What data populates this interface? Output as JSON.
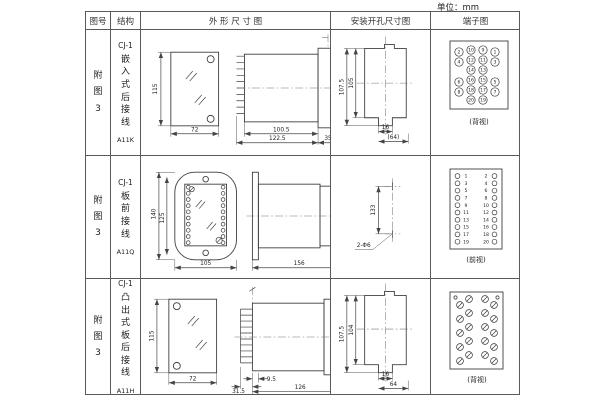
{
  "unit_label": "单位：mm",
  "headers": {
    "fig_no": "图号",
    "structure": "结构",
    "outline": "外 形 尺 寸 图",
    "install": "安装开孔尺寸图",
    "terminal": "端子图"
  },
  "rows": [
    {
      "fig_no": "附图3",
      "structure": {
        "code": "CJ-1",
        "name": "嵌入式后接线",
        "model": "A11K"
      },
      "outline": {
        "front_height": "115",
        "front_width": "72",
        "side_body": "100.5",
        "side_total": "122.5",
        "side_flange": "35"
      },
      "install": {
        "v_outer": "107.5",
        "v_inner": "105",
        "h_tab": "16",
        "h_overall": "(64)"
      },
      "terminal": {
        "view": "(背视)",
        "points": [
          {
            "n": "2",
            "x": 28,
            "y": 22,
            "r": 4.2
          },
          {
            "n": "4",
            "x": 28,
            "y": 32,
            "r": 4.2
          },
          {
            "n": "6",
            "x": 28,
            "y": 52,
            "r": 4.2
          },
          {
            "n": "8",
            "x": 28,
            "y": 62,
            "r": 4.2
          },
          {
            "n": "10",
            "x": 40,
            "y": 20,
            "r": 4.2
          },
          {
            "n": "12",
            "x": 40,
            "y": 30,
            "r": 4.2
          },
          {
            "n": "14",
            "x": 40,
            "y": 40,
            "r": 4.2
          },
          {
            "n": "16",
            "x": 40,
            "y": 50,
            "r": 4.2
          },
          {
            "n": "18",
            "x": 40,
            "y": 60,
            "r": 4.2
          },
          {
            "n": "20",
            "x": 40,
            "y": 70,
            "r": 4.2
          },
          {
            "n": "9",
            "x": 52,
            "y": 20,
            "r": 4.2
          },
          {
            "n": "11",
            "x": 52,
            "y": 30,
            "r": 4.2
          },
          {
            "n": "13",
            "x": 52,
            "y": 40,
            "r": 4.2
          },
          {
            "n": "15",
            "x": 52,
            "y": 50,
            "r": 4.2
          },
          {
            "n": "17",
            "x": 52,
            "y": 60,
            "r": 4.2
          },
          {
            "n": "19",
            "x": 52,
            "y": 70,
            "r": 4.2
          },
          {
            "n": "1",
            "x": 64,
            "y": 22,
            "r": 4.2
          },
          {
            "n": "3",
            "x": 64,
            "y": 32,
            "r": 4.2
          },
          {
            "n": "5",
            "x": 64,
            "y": 52,
            "r": 4.2
          },
          {
            "n": "7",
            "x": 64,
            "y": 62,
            "r": 4.2
          }
        ]
      }
    },
    {
      "fig_no": "附图3",
      "structure": {
        "code": "CJ-1",
        "name": "板前接线",
        "model": "A11Q"
      },
      "outline": {
        "front_outer": "140",
        "front_inner": "125",
        "front_width": "105",
        "side_length": "156",
        "side_height": "115",
        "plate_points": [
          {
            "x": 47.5,
            "y": 31,
            "r": 1.9
          },
          {
            "x": 47.5,
            "y": 37.2,
            "r": 1.9
          },
          {
            "x": 47.5,
            "y": 43.4,
            "r": 1.9
          },
          {
            "x": 47.5,
            "y": 49.6,
            "r": 1.9
          },
          {
            "x": 47.5,
            "y": 55.8,
            "r": 1.9
          },
          {
            "x": 47.5,
            "y": 62,
            "r": 1.9
          },
          {
            "x": 47.5,
            "y": 68.2,
            "r": 1.9
          },
          {
            "x": 47.5,
            "y": 74.4,
            "r": 1.9
          },
          {
            "x": 47.5,
            "y": 80.6,
            "r": 1.9
          },
          {
            "x": 47.5,
            "y": 86.8,
            "r": 1.9
          },
          {
            "x": 82.5,
            "y": 31,
            "r": 1.9
          },
          {
            "x": 82.5,
            "y": 37.2,
            "r": 1.9
          },
          {
            "x": 82.5,
            "y": 43.4,
            "r": 1.9
          },
          {
            "x": 82.5,
            "y": 49.6,
            "r": 1.9
          },
          {
            "x": 82.5,
            "y": 55.8,
            "r": 1.9
          },
          {
            "x": 82.5,
            "y": 62,
            "r": 1.9
          },
          {
            "x": 82.5,
            "y": 68.2,
            "r": 1.9
          },
          {
            "x": 82.5,
            "y": 74.4,
            "r": 1.9
          },
          {
            "x": 82.5,
            "y": 80.6,
            "r": 1.9
          },
          {
            "x": 82.5,
            "y": 86.8,
            "r": 1.9
          },
          {
            "x": 78.5,
            "y": 84.5,
            "r": 3.1,
            "slot": true
          },
          {
            "x": 51,
            "y": 33,
            "r": 2.6,
            "slot": true
          }
        ]
      },
      "install": {
        "span": "133",
        "holes": "2-Φ6"
      },
      "terminal": {
        "view": "(前视)",
        "points": [
          {
            "n": "1",
            "x": 26.5,
            "y": 20,
            "r": 2.4,
            "lx": 35,
            "ly": 20
          },
          {
            "n": "3",
            "x": 26.5,
            "y": 27.3,
            "r": 2.4,
            "lx": 35,
            "ly": 27.3
          },
          {
            "n": "5",
            "x": 26.5,
            "y": 34.6,
            "r": 2.4,
            "lx": 35,
            "ly": 34.6
          },
          {
            "n": "7",
            "x": 26.5,
            "y": 41.9,
            "r": 2.4,
            "lx": 35,
            "ly": 41.9
          },
          {
            "n": "9",
            "x": 26.5,
            "y": 49.2,
            "r": 2.4,
            "lx": 35,
            "ly": 49.2
          },
          {
            "n": "11",
            "x": 26.5,
            "y": 56.5,
            "r": 2.4,
            "lx": 35,
            "ly": 56.5
          },
          {
            "n": "13",
            "x": 26.5,
            "y": 63.8,
            "r": 2.4,
            "lx": 35,
            "ly": 63.8
          },
          {
            "n": "15",
            "x": 26.5,
            "y": 71.1,
            "r": 2.4,
            "lx": 35,
            "ly": 71.1
          },
          {
            "n": "17",
            "x": 26.5,
            "y": 78.4,
            "r": 2.4,
            "lx": 35,
            "ly": 78.4
          },
          {
            "n": "19",
            "x": 26.5,
            "y": 85.7,
            "r": 2.4,
            "lx": 35,
            "ly": 85.7
          },
          {
            "n": "2",
            "x": 63.5,
            "y": 20,
            "r": 2.4,
            "lx": 55,
            "ly": 20
          },
          {
            "n": "4",
            "x": 63.5,
            "y": 27.3,
            "r": 2.4,
            "lx": 55,
            "ly": 27.3
          },
          {
            "n": "6",
            "x": 63.5,
            "y": 34.6,
            "r": 2.4,
            "lx": 55,
            "ly": 34.6
          },
          {
            "n": "8",
            "x": 63.5,
            "y": 41.9,
            "r": 2.4,
            "lx": 55,
            "ly": 41.9
          },
          {
            "n": "10",
            "x": 63.5,
            "y": 49.2,
            "r": 2.4,
            "lx": 55,
            "ly": 49.2
          },
          {
            "n": "12",
            "x": 63.5,
            "y": 56.5,
            "r": 2.4,
            "lx": 55,
            "ly": 56.5
          },
          {
            "n": "14",
            "x": 63.5,
            "y": 63.8,
            "r": 2.4,
            "lx": 55,
            "ly": 63.8
          },
          {
            "n": "16",
            "x": 63.5,
            "y": 71.1,
            "r": 2.4,
            "lx": 55,
            "ly": 71.1
          },
          {
            "n": "18",
            "x": 63.5,
            "y": 78.4,
            "r": 2.4,
            "lx": 55,
            "ly": 78.4
          },
          {
            "n": "20",
            "x": 63.5,
            "y": 85.7,
            "r": 2.4,
            "lx": 55,
            "ly": 85.7
          }
        ]
      }
    },
    {
      "fig_no": "附图3",
      "structure": {
        "code": "CJ-1",
        "name": "凸出式板后接线",
        "model": "A11H"
      },
      "outline": {
        "front_height": "115",
        "front_width": "72",
        "pin_depth": "31.5",
        "gap": "9.5",
        "side_length": "126"
      },
      "install": {
        "v_outer": "107.5",
        "v_inner": "104",
        "h_tab": "16",
        "h_overall": "64"
      },
      "terminal": {
        "view": "(背视)",
        "points": [
          {
            "x": 24.5,
            "y": 18.5,
            "r": 1.6
          },
          {
            "x": 66.5,
            "y": 18.5,
            "r": 1.6
          },
          {
            "x": 29,
            "y": 26,
            "r": 3.4,
            "slot": true
          },
          {
            "x": 29,
            "y": 40,
            "r": 3.4,
            "slot": true
          },
          {
            "x": 29,
            "y": 54,
            "r": 3.4,
            "slot": true
          },
          {
            "x": 29,
            "y": 68,
            "r": 3.4,
            "slot": true
          },
          {
            "x": 29,
            "y": 82,
            "r": 3.4,
            "slot": true
          },
          {
            "x": 38,
            "y": 20,
            "r": 3.4,
            "slot": true
          },
          {
            "x": 38,
            "y": 34,
            "r": 3.4,
            "slot": true
          },
          {
            "x": 38,
            "y": 48,
            "r": 3.4,
            "slot": true
          },
          {
            "x": 38,
            "y": 62,
            "r": 3.4,
            "slot": true
          },
          {
            "x": 38,
            "y": 76,
            "r": 3.4,
            "slot": true
          },
          {
            "x": 54,
            "y": 20,
            "r": 3.4,
            "slot": true
          },
          {
            "x": 54,
            "y": 34,
            "r": 3.4,
            "slot": true
          },
          {
            "x": 54,
            "y": 48,
            "r": 3.4,
            "slot": true
          },
          {
            "x": 54,
            "y": 62,
            "r": 3.4,
            "slot": true
          },
          {
            "x": 54,
            "y": 76,
            "r": 3.4,
            "slot": true
          },
          {
            "x": 63,
            "y": 26,
            "r": 3.4,
            "slot": true
          },
          {
            "x": 63,
            "y": 40,
            "r": 3.4,
            "slot": true
          },
          {
            "x": 63,
            "y": 54,
            "r": 3.4,
            "slot": true
          },
          {
            "x": 63,
            "y": 68,
            "r": 3.4,
            "slot": true
          },
          {
            "x": 63,
            "y": 82,
            "r": 3.4,
            "slot": true
          }
        ]
      }
    }
  ]
}
